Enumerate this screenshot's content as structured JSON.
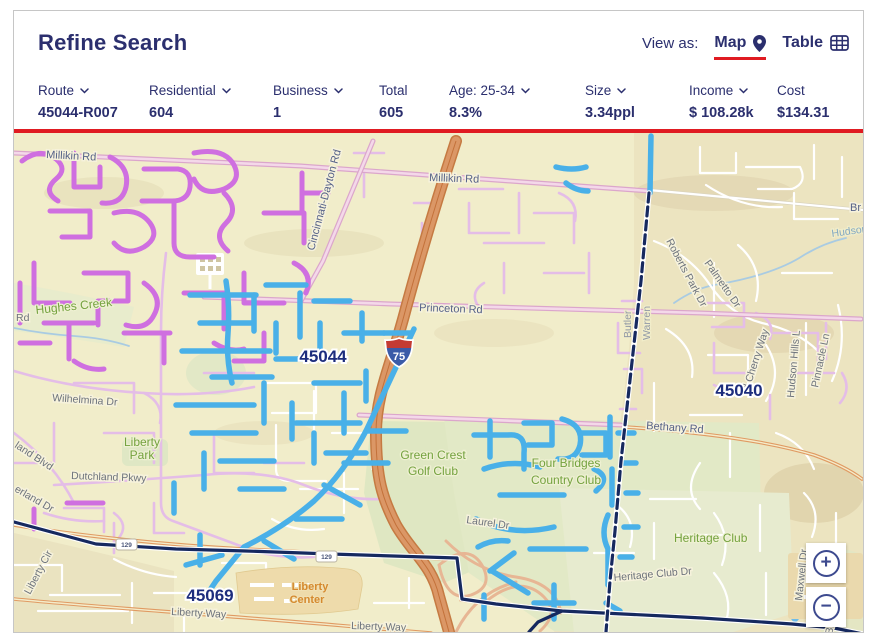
{
  "header": {
    "title": "Refine Search",
    "view_as_label": "View as:",
    "map_label": "Map",
    "table_label": "Table"
  },
  "filters": [
    {
      "label": "Route",
      "value": "45044-R007",
      "dropdown": true
    },
    {
      "label": "Residential",
      "value": "604",
      "dropdown": true
    },
    {
      "label": "Business",
      "value": "1",
      "dropdown": true
    },
    {
      "label": "Total",
      "value": "605",
      "dropdown": false
    },
    {
      "label": "Age: 25-34",
      "value": "8.3%",
      "dropdown": true
    },
    {
      "label": "Size",
      "value": "3.34ppl",
      "dropdown": true
    },
    {
      "label": "Income",
      "value": "$ 108.28k",
      "dropdown": true
    },
    {
      "label": "Cost",
      "value": "$134.31",
      "dropdown": false
    }
  ],
  "map": {
    "zips": {
      "z45044": "45044",
      "z45040": "45040",
      "z45069": "45069"
    },
    "roads": {
      "millikin": "Millikin Rd",
      "cincinnati_dayton": "Cincinnati-Dayton Rd",
      "princeton": "Princeton Rd",
      "bethany": "Bethany Rd",
      "wilhelmina": "Wilhelmina Dr",
      "dutchland_pkwy": "Dutchland Pkwy",
      "land_blvd": "land Blvd",
      "erland_dr": "erland Dr",
      "rd": "Rd",
      "liberty_cir": "Liberty Cir",
      "liberty_way": "Liberty Way",
      "heritage_club_dr": "Heritage Club Dr",
      "laurel_dr": "Laurel Dr",
      "roberts_park": "Roberts Park Dr",
      "palmetto": "Palmetto Dr",
      "cherry_way": "d Cherry Way",
      "hudson_hills": "Hudson Hills L",
      "pinnacle": "Pinnacle Ln",
      "maxwell": "Maxwell Dr",
      "brand": "Brand Ln",
      "br": "Br"
    },
    "places": {
      "liberty_park_1": "Liberty",
      "liberty_park_2": "Park",
      "green_crest_1": "Green Crest",
      "green_crest_2": "Golf Club",
      "four_bridges_1": "Four Bridges",
      "four_bridges_2": "Country Club",
      "heritage_club": "Heritage Club",
      "liberty_center_1": "Liberty",
      "liberty_center_2": "Center"
    },
    "water": {
      "hughes_creek": "Hughes Creek",
      "hudson": "Hudson"
    },
    "counties": {
      "butler": "Butler",
      "warren": "Warren"
    },
    "shields": {
      "interstate": "75",
      "route": "129"
    },
    "controls": {
      "zoom_in": "+",
      "zoom_out": "−"
    },
    "colors": {
      "selected_route": "#49b0e8",
      "other_route": "#cf6fe0",
      "boundary": "#16295f",
      "highway": "#db9766",
      "accent_red": "#e01b22",
      "navy_text": "#2b2f6e"
    }
  }
}
